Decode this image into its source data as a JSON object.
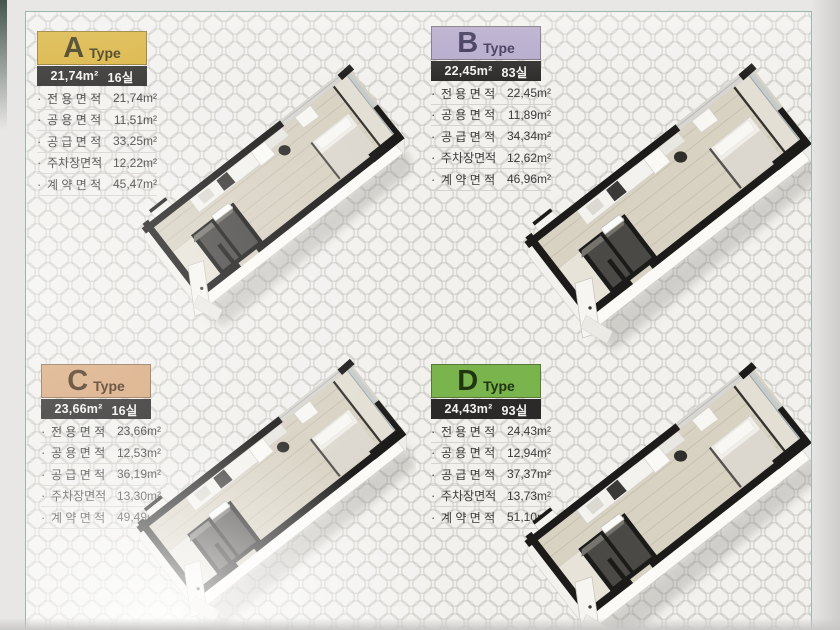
{
  "bullet": "·",
  "page": {
    "border_color": "#9cb6ae",
    "background": "#f2f1ee",
    "summary_bar_bg": "#2b2a28"
  },
  "units": [
    {
      "letter": "A",
      "type_word": "Type",
      "header_bg": "#d9b23a",
      "header_fg": "#363011",
      "bar_area": "21,74m²",
      "bar_rooms": "16실",
      "specs": [
        {
          "label": "전 용 면 적",
          "value": "21,74m²"
        },
        {
          "label": "공 용 면 적",
          "value": "11,51m²"
        },
        {
          "label": "공 급 면 적",
          "value": "33,25m²"
        },
        {
          "label": "주차장면적",
          "value": "12,22m²"
        },
        {
          "label": "계 약 면 적",
          "value": "45,47m²"
        }
      ]
    },
    {
      "letter": "B",
      "type_word": "Type",
      "header_bg": "#b3a8ca",
      "header_fg": "#372e52",
      "bar_area": "22,45m²",
      "bar_rooms": "83실",
      "specs": [
        {
          "label": "전 용 면 적",
          "value": "22,45m²"
        },
        {
          "label": "공 용 면 적",
          "value": "11,89m²"
        },
        {
          "label": "공 급 면 적",
          "value": "34,34m²"
        },
        {
          "label": "주차장면적",
          "value": "12,62m²"
        },
        {
          "label": "계 약 면 적",
          "value": "46,96m²"
        }
      ]
    },
    {
      "letter": "C",
      "type_word": "Type",
      "header_bg": "#d8a77b",
      "header_fg": "#432a11",
      "bar_area": "23,66m²",
      "bar_rooms": "16실",
      "specs": [
        {
          "label": "전 용 면 적",
          "value": "23,66m²"
        },
        {
          "label": "공 용 면 적",
          "value": "12,53m²"
        },
        {
          "label": "공 급 면 적",
          "value": "36,19m²"
        },
        {
          "label": "주차장면적",
          "value": "13,30m²"
        },
        {
          "label": "계 약 면 적",
          "value": "49,49m²"
        }
      ]
    },
    {
      "letter": "D",
      "type_word": "Type",
      "header_bg": "#79b44c",
      "header_fg": "#20350f",
      "bar_area": "24,43m²",
      "bar_rooms": "93실",
      "specs": [
        {
          "label": "전 용 면 적",
          "value": "24,43m²"
        },
        {
          "label": "공 용 면 적",
          "value": "12,94m²"
        },
        {
          "label": "공 급 면 적",
          "value": "37,37m²"
        },
        {
          "label": "주차장면적",
          "value": "13,73m²"
        },
        {
          "label": "계 약 면 적",
          "value": "51,10m²"
        }
      ]
    }
  ]
}
